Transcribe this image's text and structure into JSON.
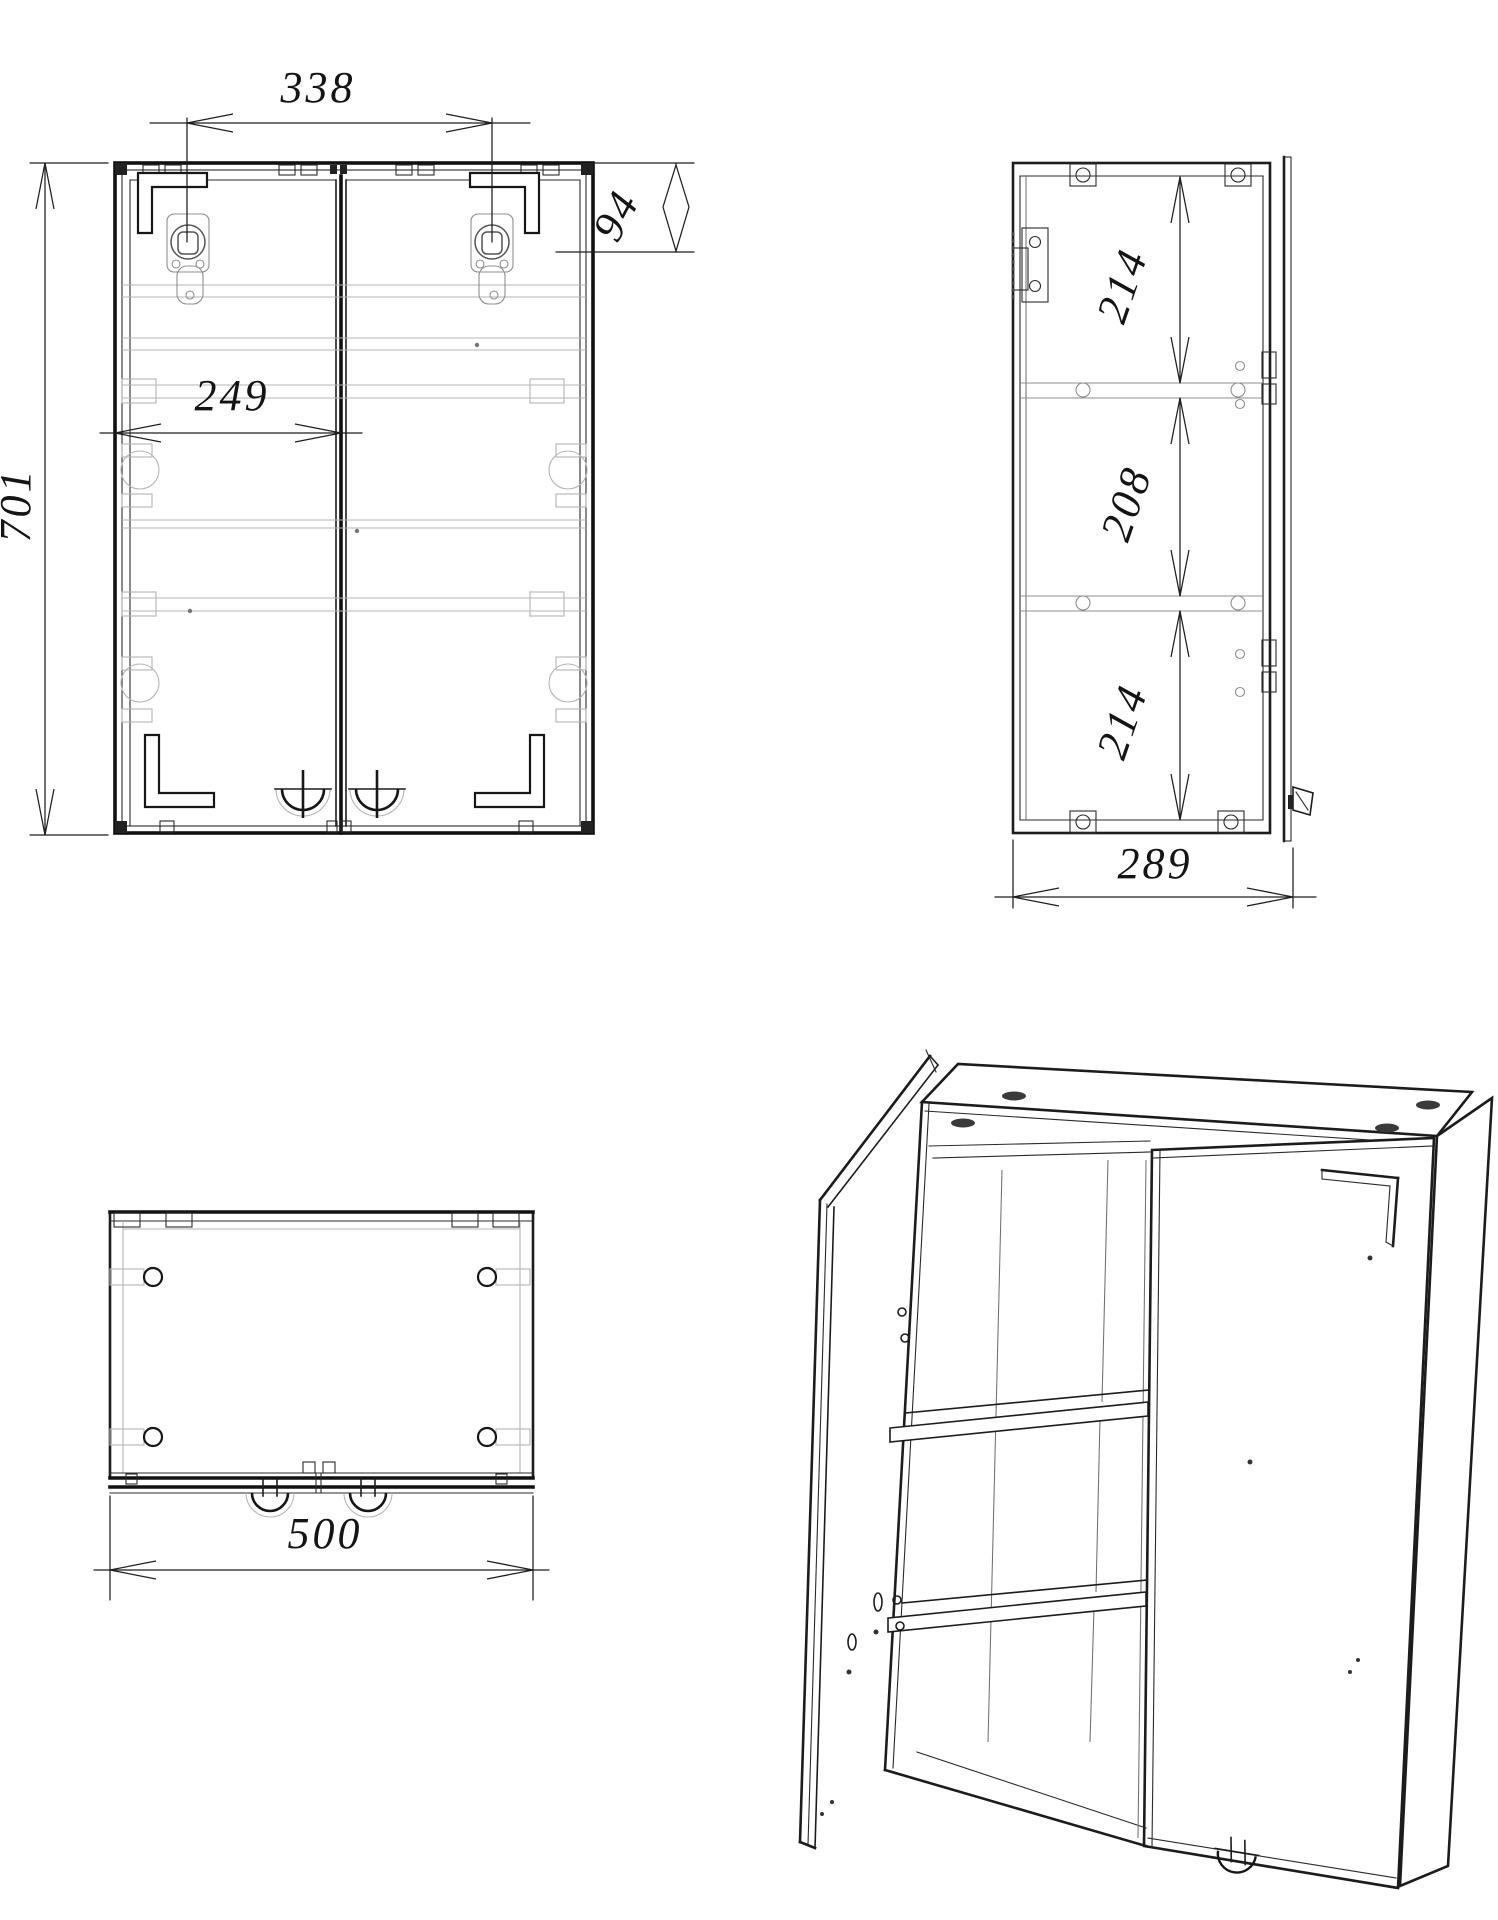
{
  "drawing": {
    "views": {
      "front": "front-view",
      "side": "side-view",
      "bottom": "bottom-view",
      "isometric": "isometric-view"
    },
    "dimensions": {
      "hinge_spacing": "338",
      "top_rail": "94",
      "overall_height": "701",
      "door_width": "249",
      "compartment_top": "214",
      "compartment_middle": "208",
      "compartment_bottom": "214",
      "depth": "289",
      "overall_width": "500"
    },
    "colors": {
      "line": "#1c1c1c",
      "ghost": "#b5b5b5",
      "background": "#ffffff"
    }
  }
}
